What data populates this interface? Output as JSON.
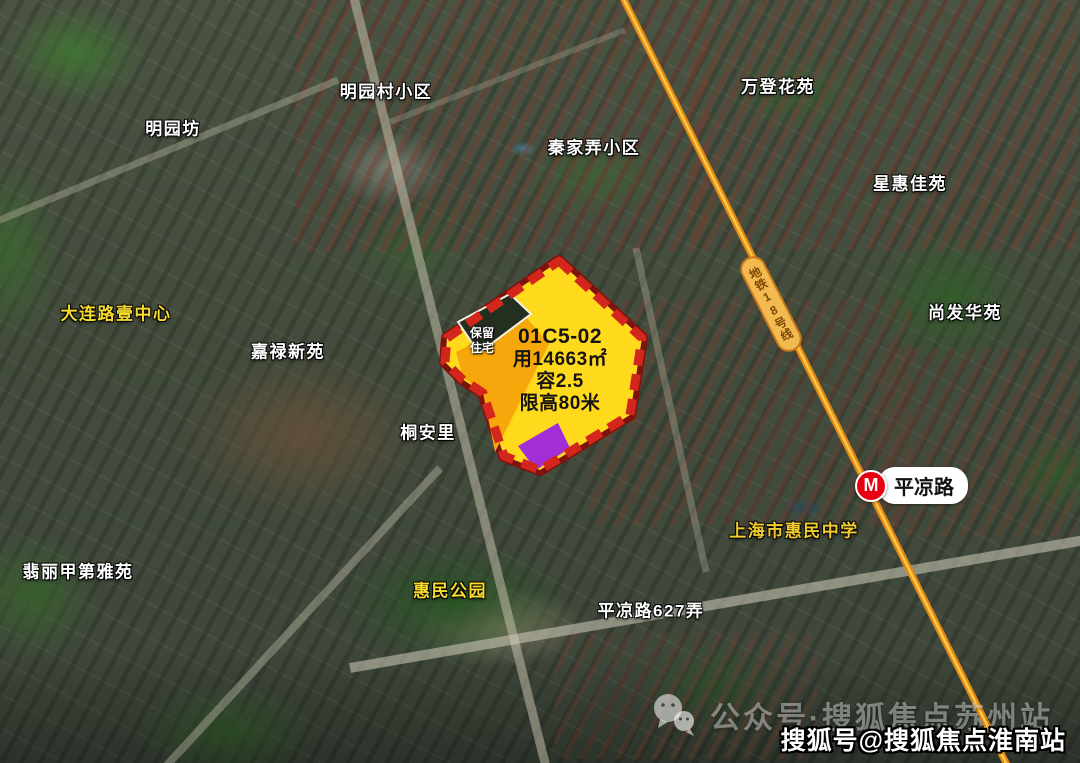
{
  "parcel": {
    "code": "01C5-02",
    "land_area": "用14663㎡",
    "plot_ratio": "容2.5",
    "height_limit": "限高80米",
    "retained_line1": "保留",
    "retained_line2": "住宅",
    "colors": {
      "fill": "#FFD91C",
      "border": "#D3261C",
      "border_dark": "#7E120C",
      "orange_zone": "#F6A70B",
      "purple_zone": "#A22ED8"
    }
  },
  "labels": [
    {
      "id": "mingyuanfang",
      "text": "明园坊",
      "color": "#FFFFFF",
      "x": 173,
      "y": 127
    },
    {
      "id": "mingyuancun",
      "text": "明园村小区",
      "color": "#FFFFFF",
      "x": 386,
      "y": 90
    },
    {
      "id": "qinjianong",
      "text": "秦家弄小区",
      "color": "#FFFFFF",
      "x": 594,
      "y": 146
    },
    {
      "id": "wandeng",
      "text": "万登花苑",
      "color": "#FFFFFF",
      "x": 778,
      "y": 85
    },
    {
      "id": "xinghui",
      "text": "星惠佳苑",
      "color": "#FFFFFF",
      "x": 910,
      "y": 182
    },
    {
      "id": "dalianlu-center",
      "text": "大连路壹中心",
      "color": "#F7DC2E",
      "x": 116,
      "y": 312
    },
    {
      "id": "jialu",
      "text": "嘉禄新苑",
      "color": "#FFFFFF",
      "x": 288,
      "y": 350
    },
    {
      "id": "shangfa",
      "text": "尚发华苑",
      "color": "#FFFFFF",
      "x": 965,
      "y": 311
    },
    {
      "id": "tonganli",
      "text": "桐安里",
      "color": "#FFFFFF",
      "x": 428,
      "y": 431
    },
    {
      "id": "feili",
      "text": "翡丽甲第雅苑",
      "color": "#FFFFFF",
      "x": 78,
      "y": 570
    },
    {
      "id": "huimin-park",
      "text": "惠民公园",
      "color": "#F7DC2E",
      "x": 450,
      "y": 589
    },
    {
      "id": "huimin-school",
      "text": "上海市惠民中学",
      "color": "#F2CC2E",
      "x": 794,
      "y": 529
    },
    {
      "id": "pinglianglu-627",
      "text": "平凉路627弄",
      "color": "#FFFFFF",
      "x": 651,
      "y": 609
    }
  ],
  "metro": {
    "line_label": "地铁18号线",
    "line_color": "#E08A15",
    "line_core_color": "#FFC84A",
    "station_name": "平凉路",
    "logo_letter": "M"
  },
  "watermarks": {
    "wechat_text": "公众号·搜狐焦点苏州站",
    "sohu_text": "搜狐号@搜狐焦点淮南站"
  },
  "icons": {
    "wechat": "wechat-icon",
    "metro_logo": "shanghai-metro-icon"
  }
}
